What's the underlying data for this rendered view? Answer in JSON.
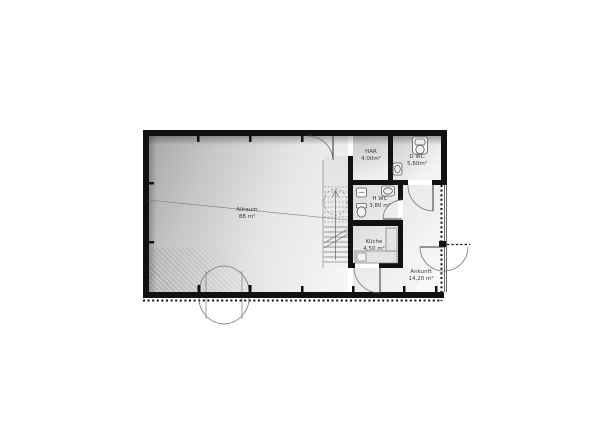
{
  "plan": {
    "rooms": [
      {
        "name": "Allraum",
        "area": "88 m²"
      },
      {
        "name": "HAR",
        "area": "4,00m²"
      },
      {
        "name": "D WC",
        "area": "5,60m²"
      },
      {
        "name": "H WC",
        "area": "3,80 m²"
      },
      {
        "name": "Küche",
        "area": "4,50 m²"
      },
      {
        "name": "Ankunft",
        "area": "14,20 m²"
      }
    ],
    "colors": {
      "wall": "#111111",
      "line": "#555555",
      "floor_dark": "#a8a8a8",
      "floor_light": "#f7f7f7"
    }
  }
}
